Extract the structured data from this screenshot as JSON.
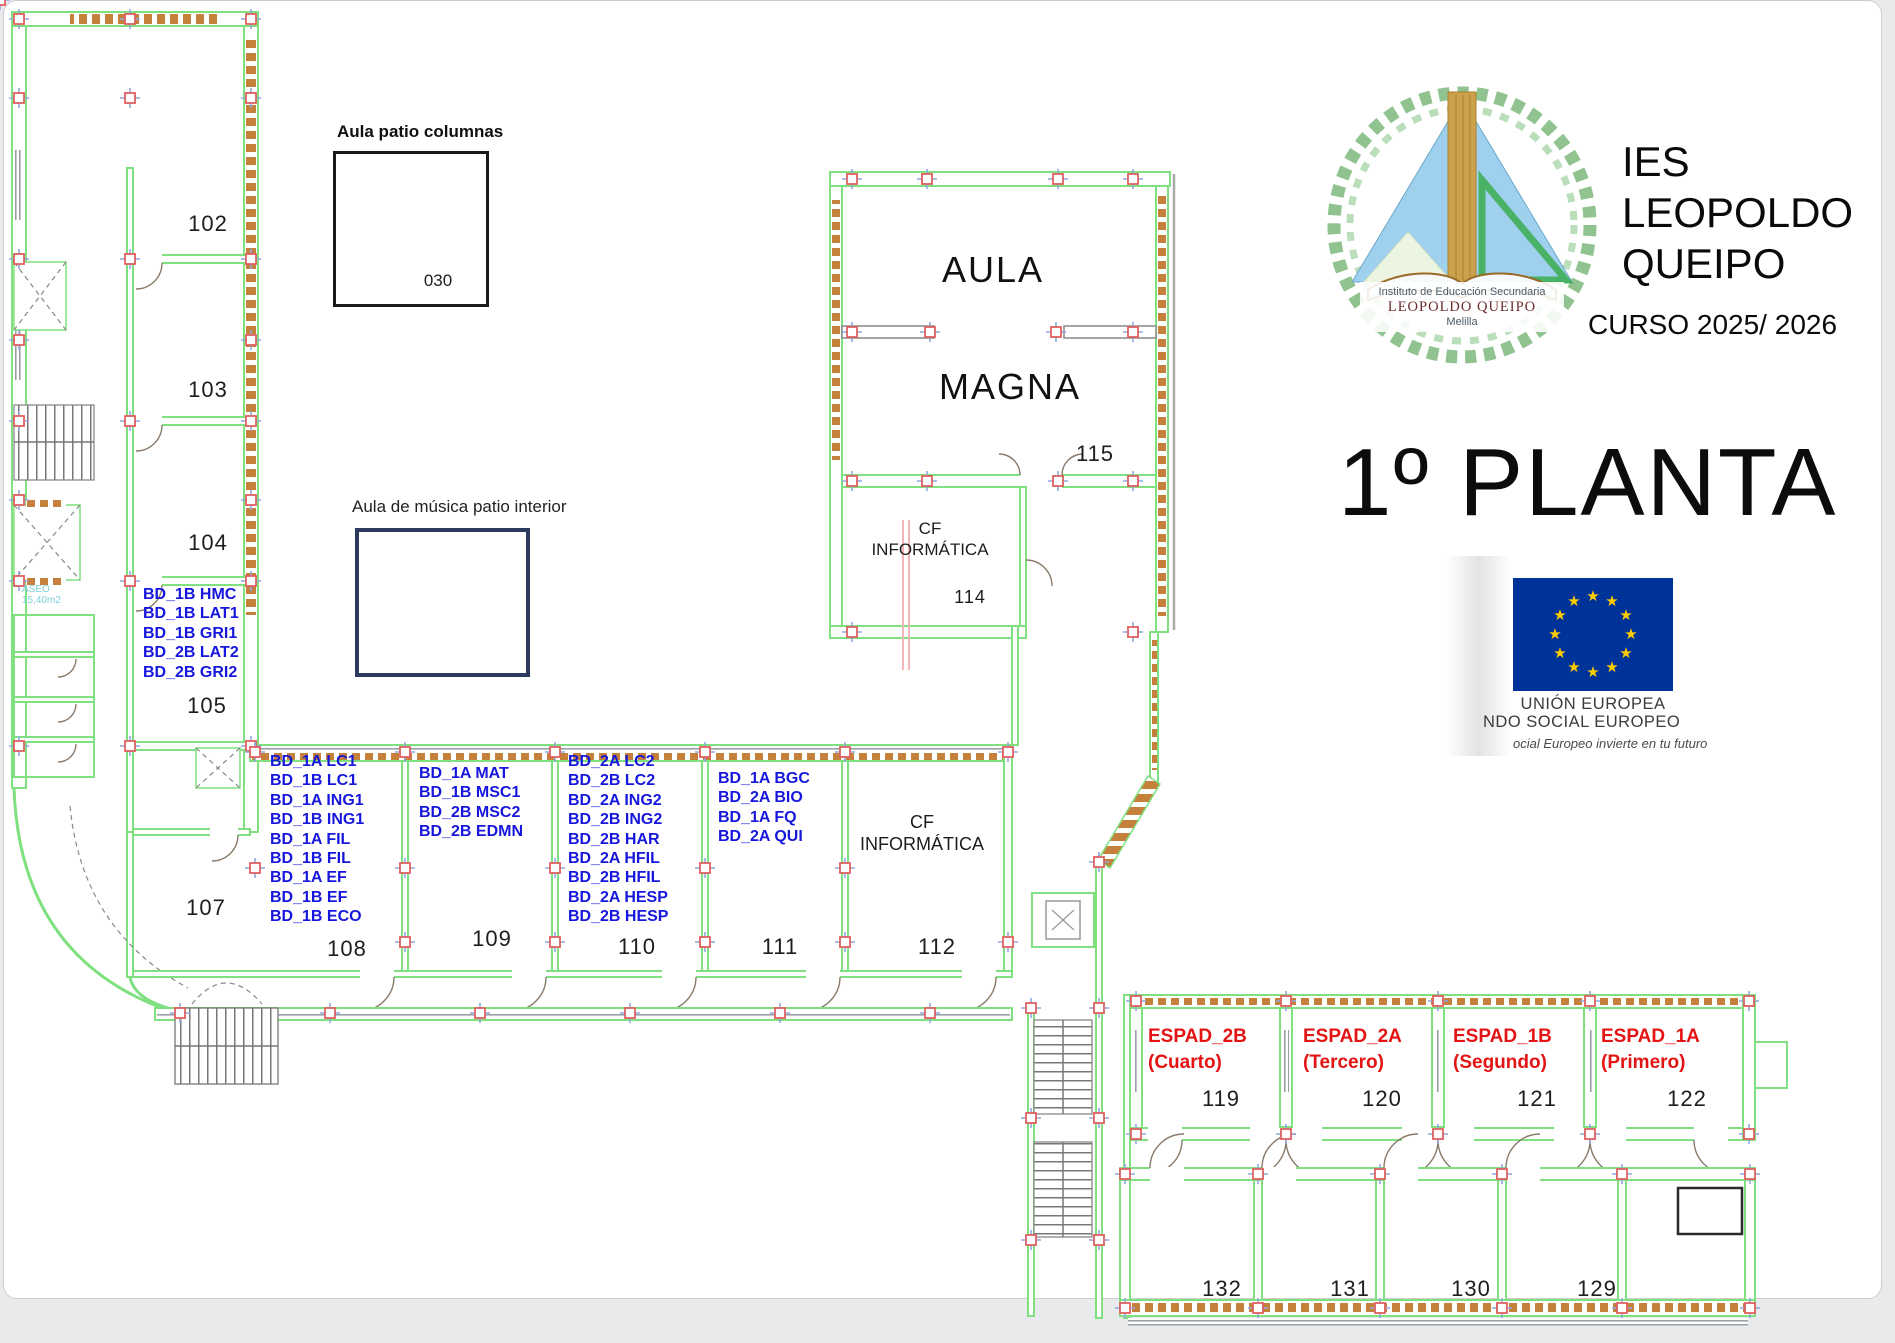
{
  "titles": {
    "patio_columnas": "Aula patio columnas",
    "musica": "Aula de música patio interior",
    "school": [
      "IES",
      "LEOPOLDO",
      "QUEIPO"
    ],
    "curso": "CURSO 2025/ 2026",
    "floor": "1º PLANTA"
  },
  "logo": {
    "line1": "Instituto de Educación Secundaria",
    "line2": "LEOPOLDO QUEIPO",
    "line3": "Melilla"
  },
  "eu_block": {
    "line1": "UNIÓN EUROPEA",
    "line2": "NDO SOCIAL EUROPEO",
    "line3": "ocial Europeo invierte en tu futuro",
    "flag_blue": "#003399",
    "star_yellow": "#ffcc00"
  },
  "rooms": {
    "r030": {
      "number": "030"
    },
    "r102": {
      "number": "102"
    },
    "r103": {
      "number": "103"
    },
    "r104": {
      "number": "104"
    },
    "r105": {
      "number": "105",
      "codes": [
        "BD_1B HMC",
        "BD_1B LAT1",
        "BD_1B GRI1",
        "BD_2B LAT2",
        "BD_2B GRI2"
      ]
    },
    "r107": {
      "number": "107"
    },
    "r108": {
      "number": "108",
      "codes": [
        "BD_1A LC1",
        "BD_1B LC1",
        "BD_1A ING1",
        "BD_1B ING1",
        "BD_1A FIL",
        "BD_1B FIL",
        "BD_1A EF",
        "BD_1B EF",
        "BD_1B ECO"
      ]
    },
    "r109": {
      "number": "109",
      "codes": [
        "BD_1A MAT",
        "BD_1B MSC1",
        "BD_2B MSC2",
        "BD_2B EDMN"
      ]
    },
    "r110": {
      "number": "110",
      "codes": [
        "BD_2A LC2",
        "BD_2B LC2",
        "BD_2A ING2",
        "BD_2B ING2",
        "BD_2B HAR",
        "BD_2A HFIL",
        "BD_2B HFIL",
        "BD_2A HESP",
        "BD_2B HESP"
      ]
    },
    "r111": {
      "number": "111",
      "codes": [
        "BD_1A BGC",
        "BD_2A BIO",
        "BD_1A FQ",
        "BD_2A QUI"
      ]
    },
    "r112": {
      "number": "112",
      "label": [
        "CF",
        "INFORMÁTICA"
      ]
    },
    "r114": {
      "number": "114",
      "label": [
        "CF",
        "INFORMÁTICA"
      ]
    },
    "r115": {
      "number": "115",
      "word1": "AULA",
      "word2": "MAGNA"
    },
    "r119": {
      "number": "119",
      "label": [
        "ESPAD_2B",
        "(Cuarto)"
      ]
    },
    "r120": {
      "number": "120",
      "label": [
        "ESPAD_2A",
        "(Tercero)"
      ]
    },
    "r121": {
      "number": "121",
      "label": [
        "ESPAD_1B",
        "(Segundo)"
      ]
    },
    "r122": {
      "number": "122",
      "label": [
        "ESPAD_1A",
        "(Primero)"
      ]
    },
    "r129": {
      "number": "129"
    },
    "r130": {
      "number": "130"
    },
    "r131": {
      "number": "131"
    },
    "r132": {
      "number": "132"
    }
  },
  "misc": {
    "aseo": [
      "ASEO",
      "15,40m2"
    ]
  },
  "colors": {
    "wall_green": "#7fe07f",
    "hatch_orange": "#c5803c",
    "code_blue": "#1616dd",
    "espad_red": "#e41414",
    "column_red": "#e06060",
    "column_blue": "#8fa8e0"
  }
}
